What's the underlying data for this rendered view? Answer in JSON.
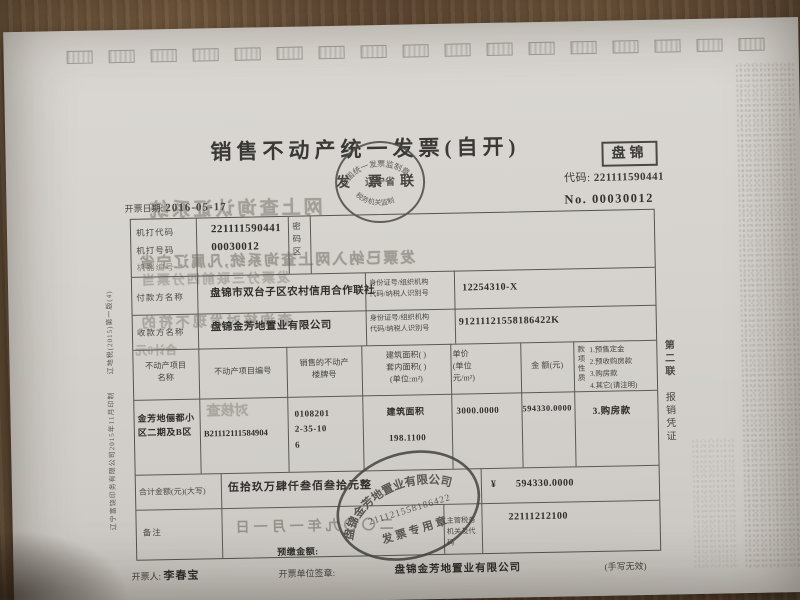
{
  "meta": {
    "region": "盘锦",
    "code_label": "代码:",
    "code": "221111590441",
    "no_label": "No.",
    "no": "00030012",
    "date_label": "开票日期:",
    "date": "2016-05-17"
  },
  "title": {
    "main": "销售不动产统一发票(自开)",
    "copy_name": "发票联"
  },
  "supervision_stamp": {
    "arc_top": "全国统一发票监制章",
    "center": "辽宁省",
    "arc_bottom": "税务机关监制"
  },
  "machine": {
    "label_code": "机打代码",
    "label_number": "机打号码",
    "label_device": "机器编号",
    "code": "221111590441",
    "number": "00030012",
    "password_label": "密码区"
  },
  "parties": [
    {
      "role": "付款方名称",
      "name": "盘锦市双台子区农村信用合作联社",
      "id_label": "身份证号/组织机构\n代码/纳税人识别号",
      "id": "12254310-X"
    },
    {
      "role": "收款方名称",
      "name": "盘锦金芳地置业有限公司",
      "id_label": "身份证号/组织机构\n代码/纳税人识别号",
      "id": "91211121558186422K"
    }
  ],
  "table": {
    "headers": {
      "c1": "不动产项目\n名称",
      "c2": "不动产项目编号",
      "c3": "销售的不动产\n楼牌号",
      "c4": "建筑面积(  )\n套内面积(  )\n(单位:m²)",
      "c5": "单价\n(单位\n元/m²)",
      "c6": "金 额(元)"
    },
    "payment_nature": {
      "label": "款项性质",
      "options": [
        "1.预售定金",
        "2.预收购房款",
        "3.购房款",
        "4.其它(请注明)"
      ],
      "selected": "3.购房款"
    },
    "row": {
      "project_name": "金芳地俪都小区二期及B区",
      "project_no": "B21112111584904",
      "building_no_l1": "0108201",
      "building_no_l2": "2-35-10",
      "building_no_l3": "6",
      "area_type": "建筑面积",
      "area": "198.1100",
      "unit_price": "3000.0000",
      "amount": "594330.0000"
    }
  },
  "total": {
    "label": "合计金额(元)(大写)",
    "cn": "伍拾玖万肆仟叁佰叁拾元整",
    "currency": "¥",
    "numeric": "594330.0000"
  },
  "remark": {
    "label": "备注",
    "bleed_date": "二〇〇九年一月一日",
    "prepay_label": "预缴金额:",
    "tax_org_label": "主管税务\n机关及代码",
    "tax_org_code": "22111212100"
  },
  "footer": {
    "issuer_label": "开票人:",
    "issuer": "李春宝",
    "unit_label": "开票单位签章:",
    "unit": "盘锦金芳地置业有限公司",
    "note": "(手写无效)"
  },
  "company_stamp": {
    "name": "盘锦金芳地置业有限公司",
    "number": "211121558186422",
    "type": "发票专用章"
  },
  "side_notes": {
    "copy_no": "第二联",
    "copy_use": "报销凭证",
    "printer": "辽宁富饶印务有限公司2015年11月印制",
    "print_code": "辽地税(2015)第一版(4)"
  },
  "bleed_lines": [
    "网上查询认证系统",
    "发票已纳入网上查询系统,凡属辽宁省",
    "发票分三联前四分票当",
    "查询核对发现不符的",
    "合计0元",
    "对核查"
  ],
  "artifact_boxes": 17
}
